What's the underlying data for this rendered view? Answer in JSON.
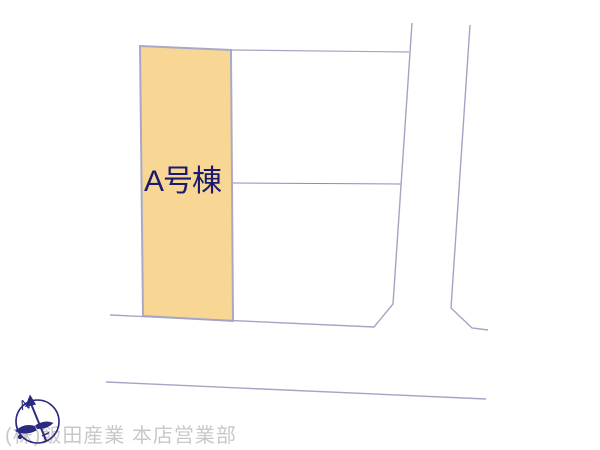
{
  "canvas": {
    "width": 600,
    "height": 450,
    "background": "#ffffff"
  },
  "plot": {
    "label": "A号棟",
    "fill": "#F8D794",
    "stroke": "#A9A9C7",
    "label_color": "#1B1B6E"
  },
  "lines": {
    "boundary_color": "#A4A4C4",
    "divider_color": "#8A8AC6"
  },
  "compass": {
    "north_label": "N",
    "color": "#2A2A80"
  },
  "footer": {
    "text": "(株)飯田産業 本店営業部",
    "color": "#C8C8C8"
  }
}
